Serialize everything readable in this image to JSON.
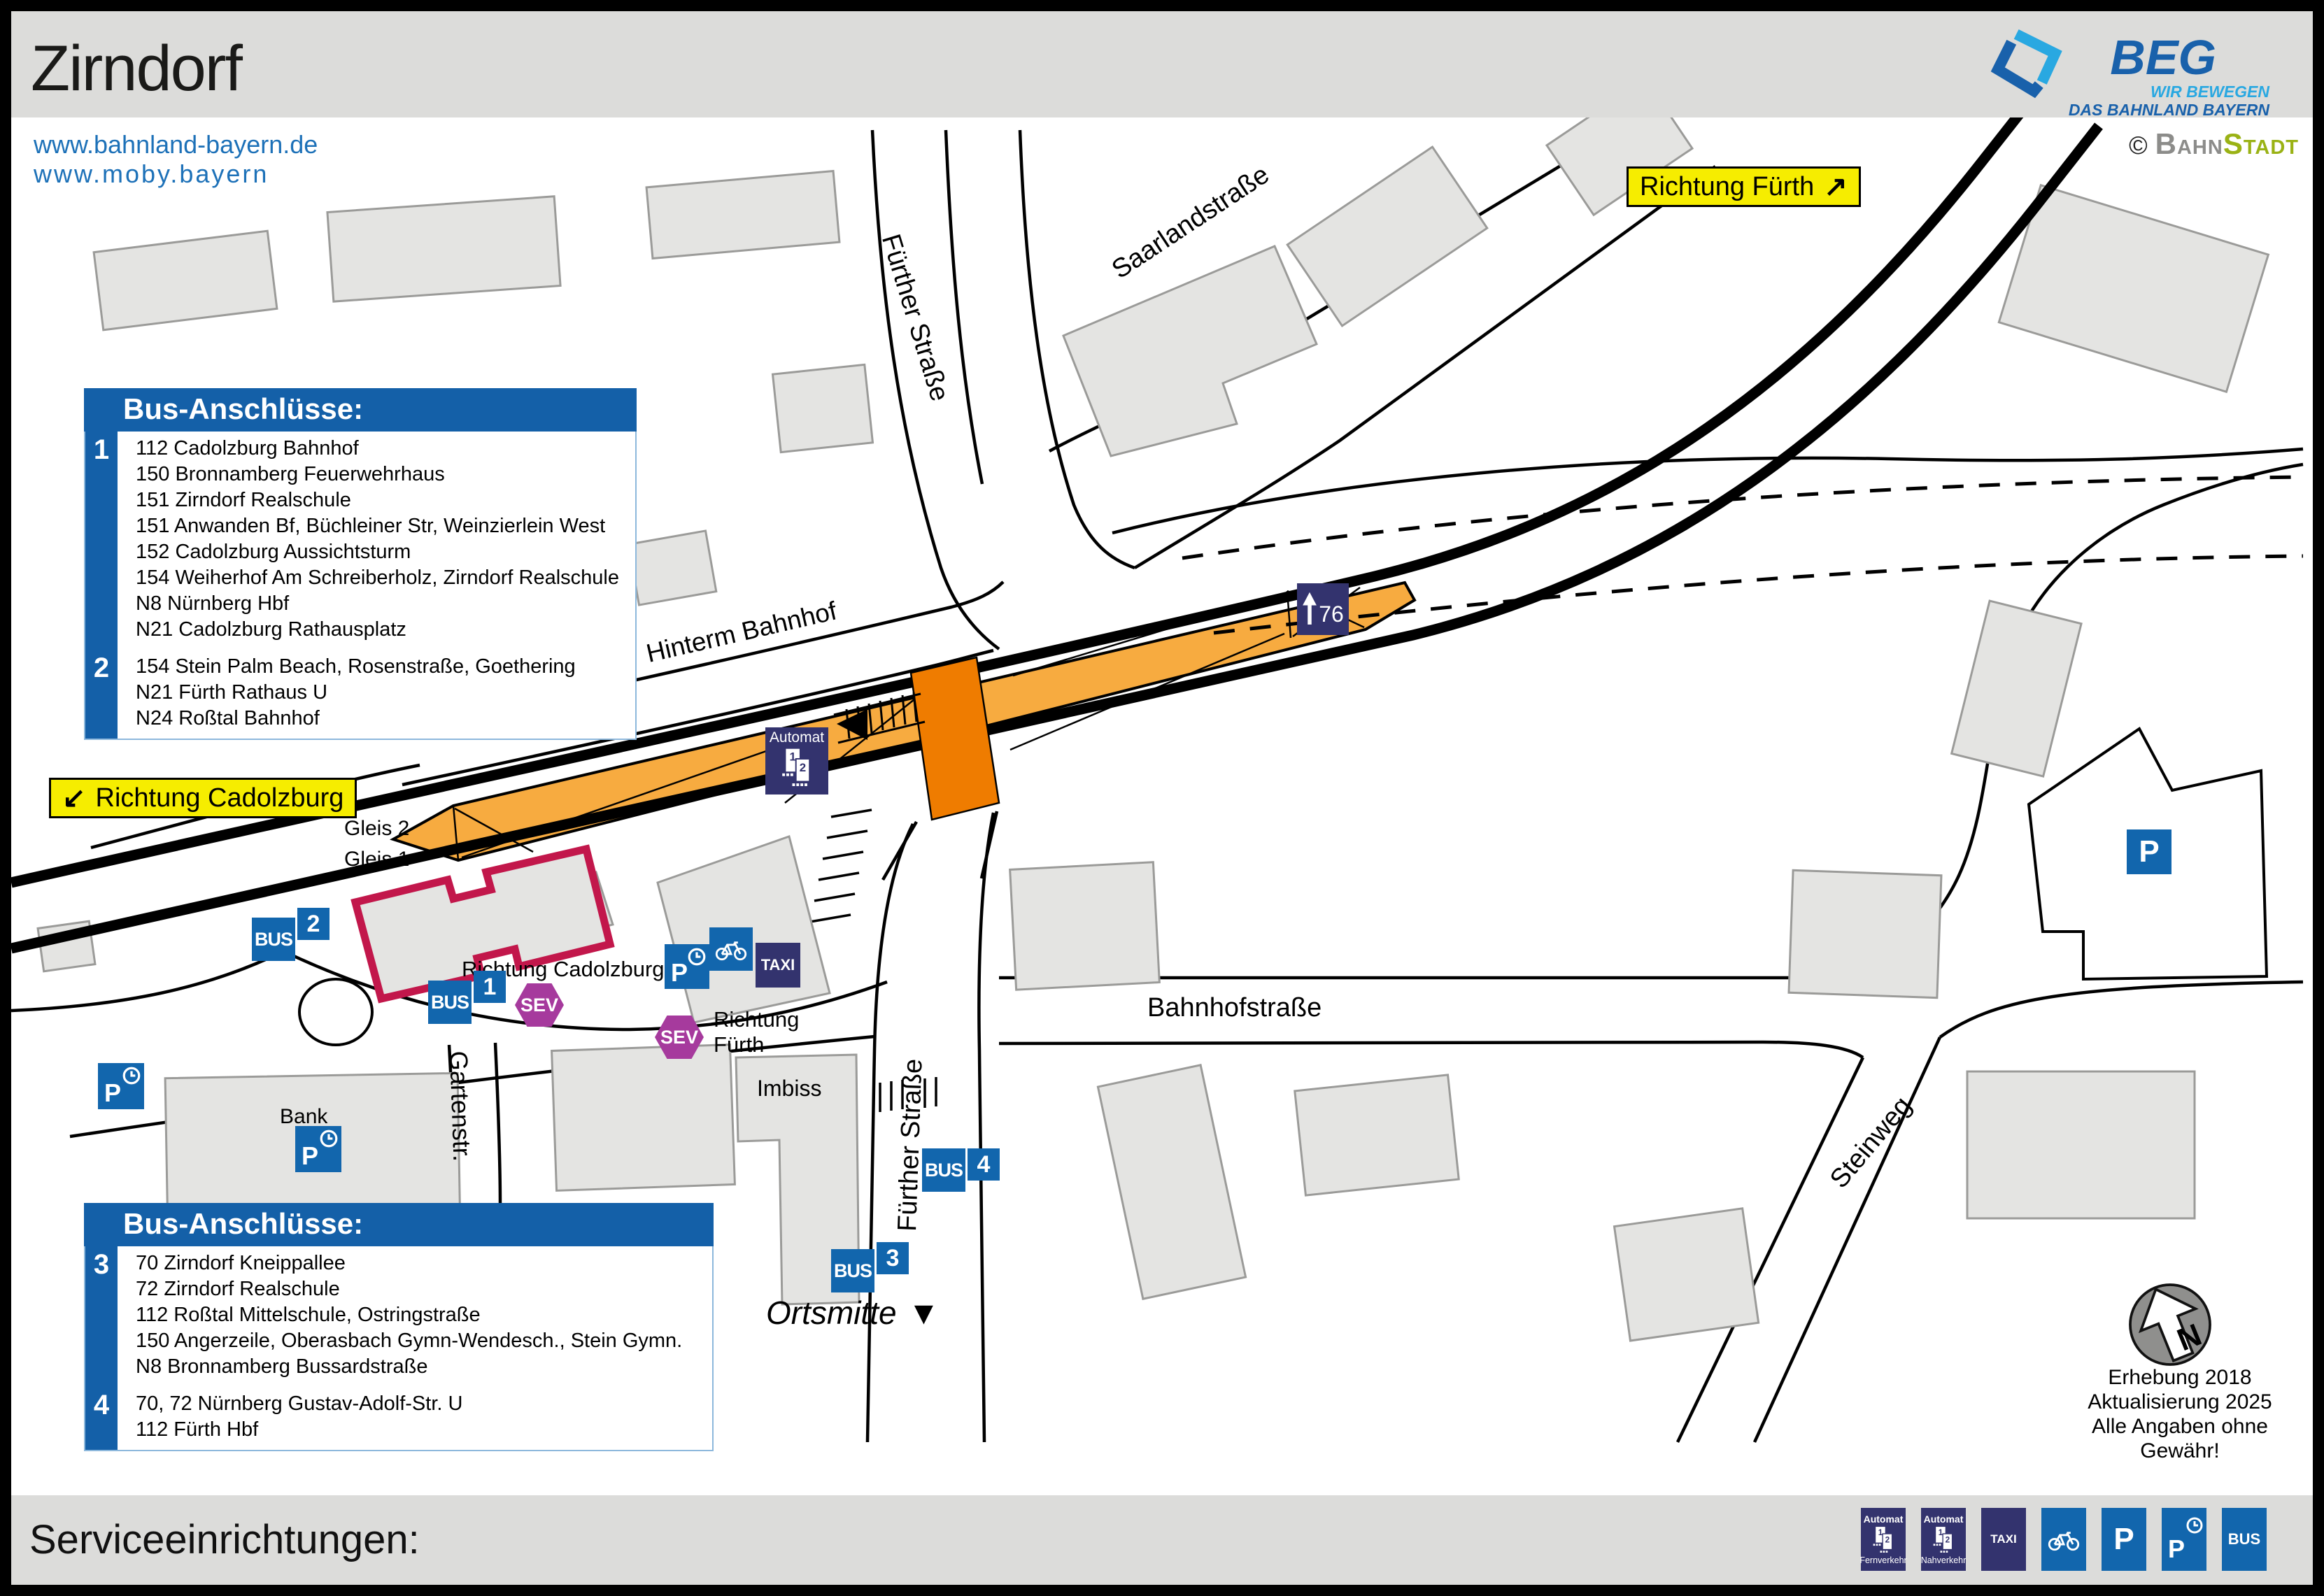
{
  "header": {
    "title": "Zirndorf"
  },
  "branding": {
    "beg": {
      "name": "BEG",
      "tagline_line1": "WIR BEWEGEN",
      "tagline_line2": "DAS BAHNLAND BAYERN"
    },
    "credit": {
      "copyright": "©",
      "part1": "Bahn",
      "part2": "Stadt"
    }
  },
  "links": {
    "line1": "www.bahnland-bayern.de",
    "line2": "www.moby.bayern"
  },
  "direction_signs": {
    "fuerth": {
      "label": "Richtung Fürth",
      "arrow": "↗"
    },
    "cadolzburg": {
      "label": "Richtung Cadolzburg",
      "arrow": "↙"
    }
  },
  "bus_boxes": [
    {
      "title": "Bus-Anschlüsse:",
      "groups": [
        {
          "stop": "1",
          "lines": [
            "112 Cadolzburg Bahnhof",
            "150 Bronnamberg Feuerwehrhaus",
            "151 Zirndorf Realschule",
            "151 Anwanden Bf, Büchleiner Str, Weinzierlein West",
            "152 Cadolzburg Aussichtsturm",
            "154 Weiherhof Am Schreiberholz, Zirndorf Realschule",
            "N8 Nürnberg Hbf",
            "N21 Cadolzburg Rathausplatz"
          ]
        },
        {
          "stop": "2",
          "lines": [
            "154 Stein Palm Beach, Rosenstraße, Goethering",
            "N21 Fürth Rathaus U",
            "N24 Roßtal Bahnhof"
          ]
        }
      ]
    },
    {
      "title": "Bus-Anschlüsse:",
      "groups": [
        {
          "stop": "3",
          "lines": [
            "70 Zirndorf Kneippallee",
            "72 Zirndorf Realschule",
            "112 Roßtal Mittelschule, Ostringstraße",
            "150 Angerzeile, Oberasbach Gymn-Wendesch., Stein Gymn.",
            "N8 Bronnamberg Bussardstraße"
          ]
        },
        {
          "stop": "4",
          "lines": [
            "70, 72 Nürnberg Gustav-Adolf-Str. U",
            "112 Fürth Hbf"
          ]
        }
      ]
    }
  ],
  "streets": {
    "fuerther_top": "Fürther Straße",
    "saarland": "Saarlandstraße",
    "hinterm": "Hinterm Bahnhof",
    "bahnhof": "Bahnhofstraße",
    "garten": "Gartenstr.",
    "fuerther_bottom": "Fürther Straße",
    "steinweg": "Steinweg"
  },
  "map_labels": {
    "gleis2": "Gleis 2",
    "gleis1": "Gleis 1",
    "bank": "Bank",
    "imbiss": "Imbiss",
    "ortsmitte": "Ortsmitte",
    "ortsmitte_marker": "▼",
    "richtung_cadolzburg": "Richtung Cadolzburg",
    "richtung_fuerth_line1": "Richtung",
    "richtung_fuerth_line2": "Fürth",
    "track_sign": "76",
    "track_sign_arrow": "↑"
  },
  "stops": {
    "bus_label": "BUS",
    "sev_label": "SEV",
    "taxi_label": "TAXI",
    "parking_label": "P",
    "automat_label": "Automat",
    "numbers": {
      "stop1": "1",
      "stop2": "2",
      "stop3": "3",
      "stop4": "4"
    },
    "automat_glyph": {
      "one": "1",
      "two": "2"
    }
  },
  "footer": {
    "title": "Serviceeinrichtungen:",
    "legend": [
      {
        "type": "automat",
        "label": "Automat",
        "sub": "Fernverkehr"
      },
      {
        "type": "automat",
        "label": "Automat",
        "sub": "Nahverkehr"
      },
      {
        "type": "taxi",
        "label": "TAXI"
      },
      {
        "type": "bike"
      },
      {
        "type": "parking",
        "label": "P"
      },
      {
        "type": "parking-clock",
        "label": "P"
      },
      {
        "type": "bus",
        "label": "BUS"
      }
    ]
  },
  "survey": {
    "line1": "Erhebung 2018",
    "line2": "Aktualisierung 2025",
    "line3": "Alle Angaben ohne Gewähr!"
  },
  "compass": {
    "label": "N"
  },
  "colors": {
    "accent_blue": "#1266ad",
    "box_blue": "#1460a8",
    "navy": "#33336e",
    "sev_purple": "#a63a9d",
    "platform_orange": "#f7ab40",
    "crossing_orange": "#ef7c00",
    "sign_yellow": "#f6ed00",
    "station_outline_red": "#c2174b",
    "link_blue": "#1d71b8",
    "beg_lightblue": "#29a8e1",
    "beg_darkblue": "#1961ab",
    "bahn_gray": "#8c8c8a",
    "stadt_green": "#9ab215",
    "building_gray": "#e4e4e2"
  }
}
